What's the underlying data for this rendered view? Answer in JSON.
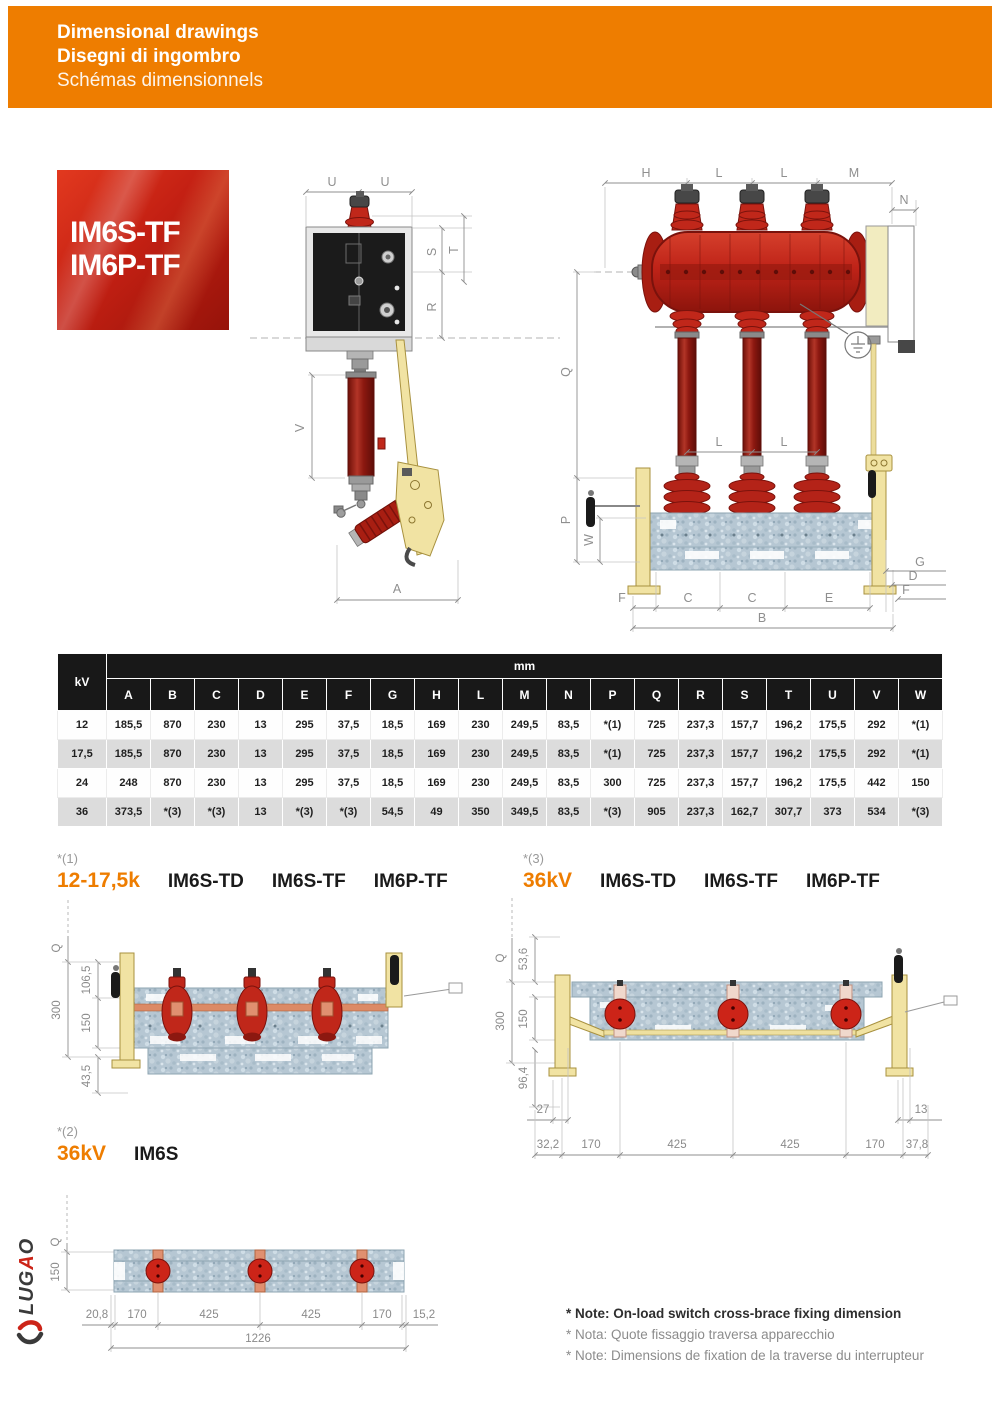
{
  "header": {
    "title_en": "Dimensional drawings",
    "title_it": "Disegni di ingombro",
    "title_fr": "Schémas dimensionnels"
  },
  "badge": {
    "line1": "IM6S-TF",
    "line2": "IM6P-TF"
  },
  "dims": {
    "A": "A",
    "B": "B",
    "C": "C",
    "D": "D",
    "E": "E",
    "F": "F",
    "G": "G",
    "H": "H",
    "L": "L",
    "M": "M",
    "N": "N",
    "P": "P",
    "Q": "Q",
    "R": "R",
    "S": "S",
    "T": "T",
    "U": "U",
    "V": "V",
    "W": "W"
  },
  "table": {
    "kv_header": "kV",
    "unit_header": "mm",
    "columns": [
      "A",
      "B",
      "C",
      "D",
      "E",
      "F",
      "G",
      "H",
      "L",
      "M",
      "N",
      "P",
      "Q",
      "R",
      "S",
      "T",
      "U",
      "V",
      "W"
    ],
    "rows": [
      {
        "kv": "12",
        "values": [
          "185,5",
          "870",
          "230",
          "13",
          "295",
          "37,5",
          "18,5",
          "169",
          "230",
          "249,5",
          "83,5",
          "*(1)",
          "725",
          "237,3",
          "157,7",
          "196,2",
          "175,5",
          "292",
          "*(1)"
        ]
      },
      {
        "kv": "17,5",
        "values": [
          "185,5",
          "870",
          "230",
          "13",
          "295",
          "37,5",
          "18,5",
          "169",
          "230",
          "249,5",
          "83,5",
          "*(1)",
          "725",
          "237,3",
          "157,7",
          "196,2",
          "175,5",
          "292",
          "*(1)"
        ]
      },
      {
        "kv": "24",
        "values": [
          "248",
          "870",
          "230",
          "13",
          "295",
          "37,5",
          "18,5",
          "169",
          "230",
          "249,5",
          "83,5",
          "300",
          "725",
          "237,3",
          "157,7",
          "196,2",
          "175,5",
          "442",
          "150"
        ]
      },
      {
        "kv": "36",
        "values": [
          "373,5",
          "*(3)",
          "*(3)",
          "13",
          "*(3)",
          "*(3)",
          "54,5",
          "49",
          "350",
          "349,5",
          "83,5",
          "*(3)",
          "905",
          "237,3",
          "162,7",
          "307,7",
          "373",
          "534",
          "*(3)"
        ]
      }
    ]
  },
  "sections": {
    "s1": {
      "ref": "*(1)",
      "range": "12-17,5k",
      "models": [
        "IM6S-TD",
        "IM6S-TF",
        "IM6P-TF"
      ]
    },
    "s3": {
      "ref": "*(3)",
      "range": "36kV",
      "models": [
        "IM6S-TD",
        "IM6S-TF",
        "IM6P-TF"
      ]
    },
    "s2": {
      "ref": "*(2)",
      "range": "36kV",
      "models": [
        "IM6S"
      ]
    }
  },
  "detail1": {
    "q": "Q",
    "v300": "300",
    "v106": "106,5",
    "v150": "150",
    "v43": "43,5"
  },
  "detail3": {
    "q": "Q",
    "v53": "53,6",
    "v300": "300",
    "v150": "150",
    "v96": "96,4",
    "v27": "27",
    "v13": "13",
    "bottom": [
      "32,2",
      "170",
      "425",
      "425",
      "170",
      "37,8"
    ]
  },
  "detail2": {
    "q": "Q",
    "v150": "150",
    "total": "1226",
    "bottom": [
      "20,8",
      "170",
      "425",
      "425",
      "170",
      "15,2"
    ]
  },
  "notes": {
    "en": "* Note: On-load switch cross-brace fixing dimension",
    "it": "* Nota: Quote fissaggio traversa apparecchio",
    "fr": "* Note: Dimensions de fixation de la traverse du interrupteur"
  },
  "logo": {
    "part1": "LUG",
    "part2": "A",
    "part3": "O"
  },
  "colors": {
    "accent_orange": "#ee7d00",
    "drawing_red": "#c0271a",
    "header_black": "#181818",
    "row_gray": "#dcdcdc"
  }
}
